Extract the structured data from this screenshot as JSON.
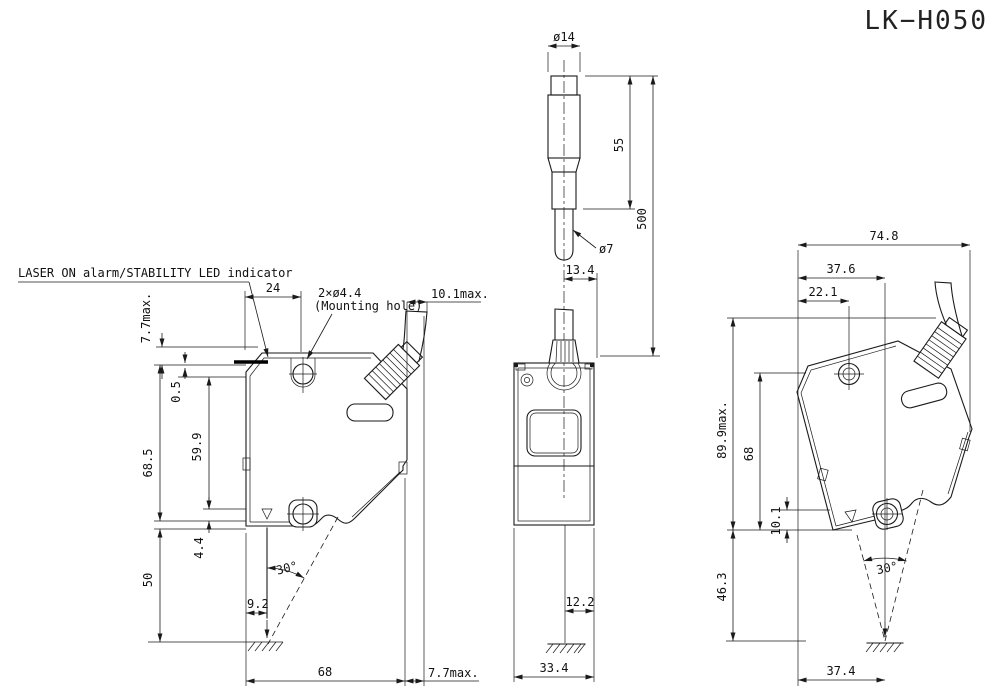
{
  "title": "LK−H050",
  "colors": {
    "line": "#1a1a1a",
    "background": "#ffffff"
  },
  "annotations": {
    "led_label": "LASER ON alarm/STABILITY LED indicator",
    "mount_label_qty": "2×ø4.4",
    "mount_label_note": "(Mounting hole)"
  },
  "cable_detail": {
    "connector_dia": "ø14",
    "connector_len": "55",
    "cable_len": "500",
    "cable_dia": "ø7",
    "offset": "13.4"
  },
  "side_view": {
    "hole_offset": "24",
    "top_protrusion": "7.7max.",
    "cable_protrusion": "10.1max.",
    "led_height": "0.5",
    "beam_axis": "59.9",
    "body_height": "68.5",
    "axis_to_bottom": "4.4",
    "standoff": "50",
    "spot_offset": "9.2",
    "beam_angle": "30°",
    "width": "68",
    "rear_protrusion": "7.7max."
  },
  "front_view": {
    "spot_offset": "12.2",
    "width": "33.4"
  },
  "right_view": {
    "overall_width": "74.8",
    "to_beam": "37.6",
    "to_hole": "22.1",
    "overall_height": "89.9max.",
    "body_height": "68",
    "foot_height": "10.1",
    "standoff": "46.3",
    "beam_angle": "30°",
    "bottom_width": "37.4"
  }
}
